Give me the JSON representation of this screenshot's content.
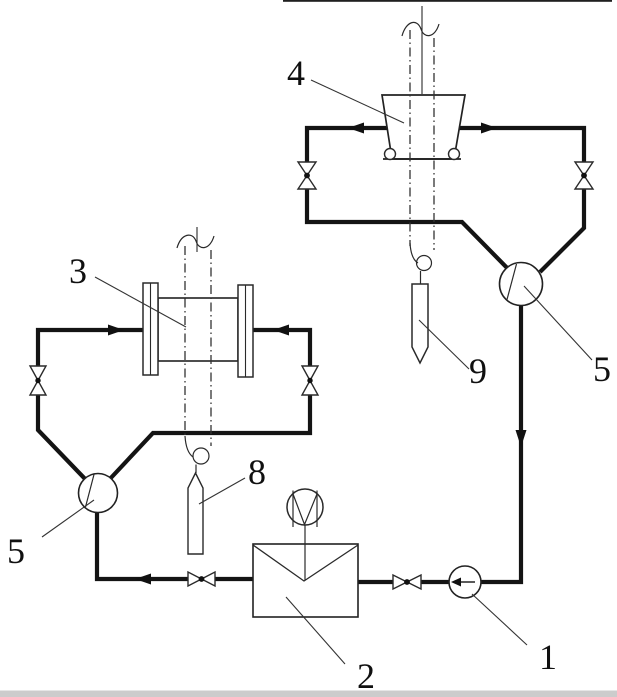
{
  "figure": {
    "bg": "#ffffff",
    "ink": "#141414",
    "shadow_gray": "#c3c3c3",
    "labels": {
      "l1": "1",
      "l2": "2",
      "l3": "3",
      "l4": "4",
      "l5_left": "5",
      "l5_right": "5",
      "l8": "8",
      "l9": "9"
    }
  }
}
